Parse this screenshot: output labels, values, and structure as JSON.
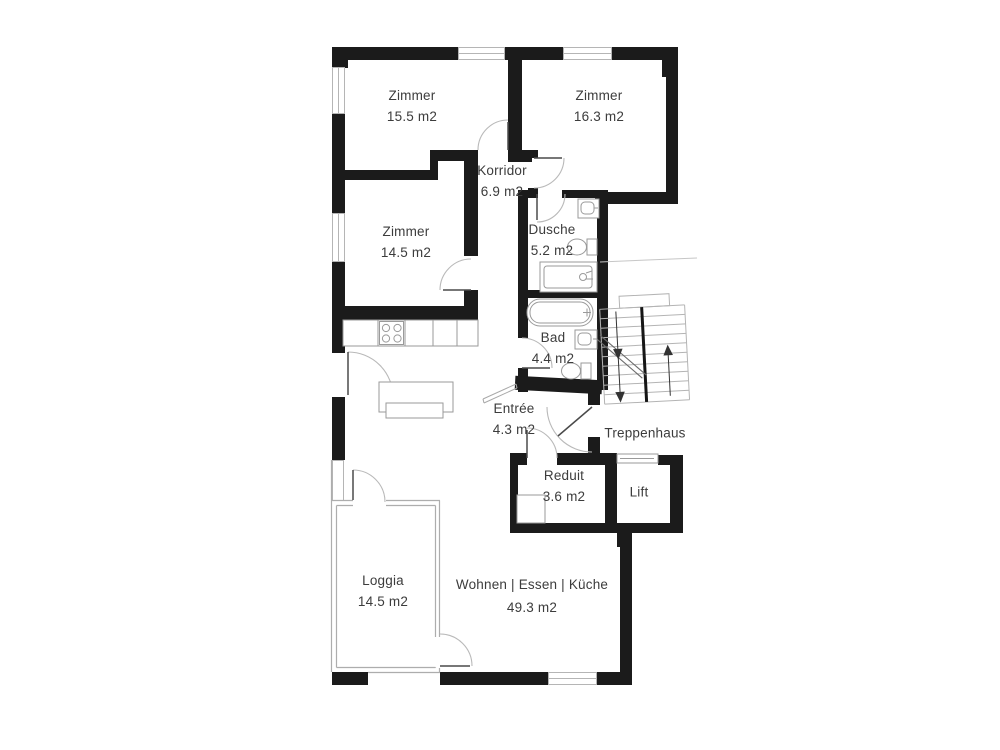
{
  "plan_type": "floor-plan",
  "language": "de",
  "colors": {
    "wall": "#1b1b1b",
    "fixture_line": "#9a9a9a",
    "door_arc": "#b9b9b9",
    "stair_line": "#b4b4b4",
    "label_text": "#3c3c3c",
    "background": "#ffffff"
  },
  "rooms": [
    {
      "id": "zimmer-1",
      "label": "Zimmer",
      "area": "15.5 m2"
    },
    {
      "id": "zimmer-2",
      "label": "Zimmer",
      "area": "16.3 m2"
    },
    {
      "id": "korridor",
      "label": "Korridor",
      "area": "6.9 m2"
    },
    {
      "id": "zimmer-3",
      "label": "Zimmer",
      "area": "14.5 m2"
    },
    {
      "id": "dusche",
      "label": "Dusche",
      "area": "5.2 m2"
    },
    {
      "id": "bad",
      "label": "Bad",
      "area": "4.4 m2"
    },
    {
      "id": "entree",
      "label": "Entrée",
      "area": "4.3 m2"
    },
    {
      "id": "treppenhaus",
      "label": "Treppenhaus",
      "area": ""
    },
    {
      "id": "reduit",
      "label": "Reduit",
      "area": "3.6 m2"
    },
    {
      "id": "lift",
      "label": "Lift",
      "area": ""
    },
    {
      "id": "loggia",
      "label": "Loggia",
      "area": "14.5 m2"
    },
    {
      "id": "wohnen",
      "label": "Wohnen | Essen | Küche",
      "area": "49.3 m2"
    }
  ]
}
